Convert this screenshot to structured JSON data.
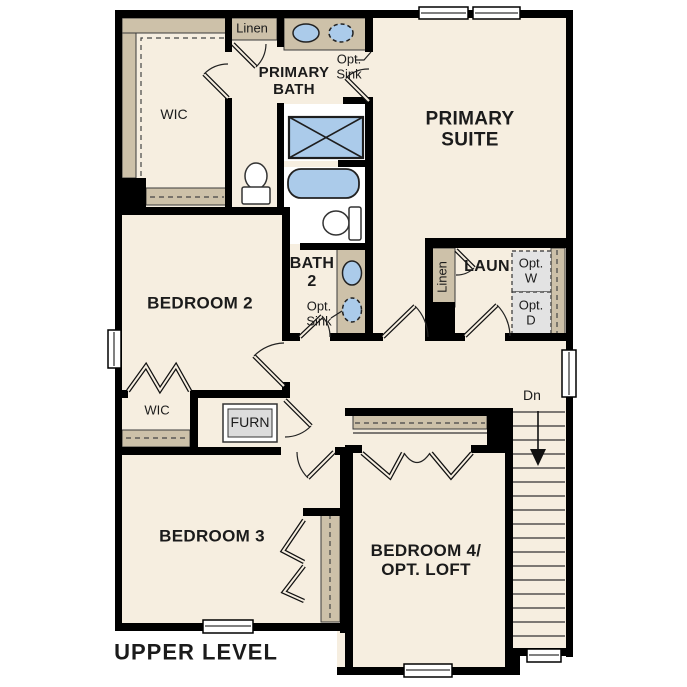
{
  "title": "UPPER LEVEL",
  "colors": {
    "floor": "#f6eee0",
    "shelf_tan": "#cdc1a9",
    "wall_black": "#000000",
    "fixture_blue": "#abcbea",
    "wet_room_white": "#ffffff",
    "furnace_gray": "#dcdcdc",
    "opt_appliance_gray": "#e3e3e3",
    "text": "#1b1b1b"
  },
  "labels": {
    "upper_level": "UPPER LEVEL",
    "primary_suite": "PRIMARY\nSUITE",
    "primary_bath": "PRIMARY\nBATH",
    "wic_top": "WIC",
    "wic_lower": "WIC",
    "linen_top": "Linen",
    "linen_laundry": "Linen",
    "opt_sink_top": "Opt.\nSink",
    "opt_sink_bath2": "Opt.\nSink",
    "bath2": "BATH\n2",
    "bedroom2": "BEDROOM 2",
    "bedroom3": "BEDROOM 3",
    "bedroom4": "BEDROOM 4/\nOPT. LOFT",
    "laundry": "LAUN",
    "opt_washer": "Opt.\nW",
    "opt_dryer": "Opt.\nD",
    "furnace": "FURN",
    "stairs_dn": "Dn"
  },
  "stairs": {
    "label": "Dn",
    "direction": "down",
    "tread_count": 17
  },
  "fixtures": [
    "shower",
    "bathtub",
    "toilet-water-closet",
    "toilet-bath2",
    "sink-primary-standard",
    "sink-primary-optional",
    "sink-bath2-standard",
    "sink-bath2-optional",
    "furnace",
    "optional-washer",
    "optional-dryer"
  ],
  "level_name": "UPPER LEVEL"
}
